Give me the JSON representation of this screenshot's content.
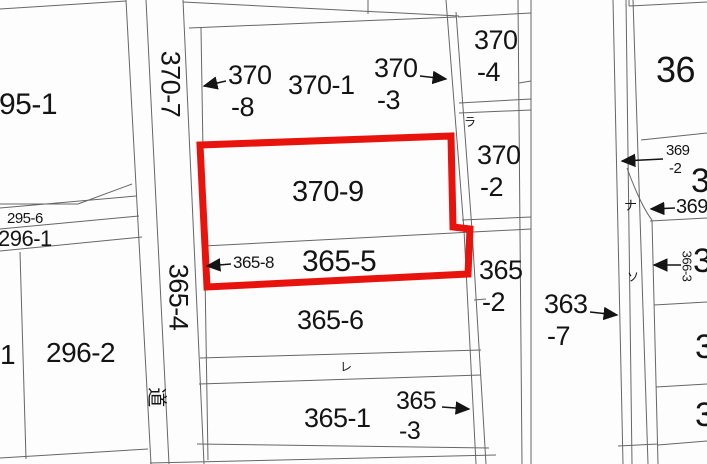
{
  "map": {
    "type": "cadastral-parcel-map",
    "colors": {
      "background": "#fdfdfd",
      "boundary_line": "#666666",
      "label_text": "#141414",
      "highlight_outline": "#e8130d"
    },
    "highlighted_parcels": [
      "370-9",
      "365-5"
    ],
    "labels": {
      "p295_1": {
        "text": "95-1"
      },
      "p370_7": {
        "text": "370-7"
      },
      "p370_8": {
        "line1": "370",
        "line2": "-8",
        "label": "370-8"
      },
      "p370_1": {
        "text": "370-1"
      },
      "p370_3": {
        "line1": "370",
        "line2": "-3",
        "label": "370-3"
      },
      "p370_4": {
        "line1": "370",
        "line2": "-4",
        "label": "370-4"
      },
      "p370_2": {
        "line1": "370",
        "line2": "-2",
        "label": "370-2"
      },
      "p370_9": {
        "text": "370-9"
      },
      "p365_8": {
        "text": "365-8"
      },
      "p365_5": {
        "text": "365-5"
      },
      "p365_4": {
        "text": "365-4"
      },
      "p365_6": {
        "text": "365-6"
      },
      "p365_1": {
        "text": "365-1"
      },
      "p365_3": {
        "line1": "365",
        "line2": "-3",
        "label": "365-3"
      },
      "p365_2": {
        "line1": "365",
        "line2": "-2",
        "label": "365-2"
      },
      "p363_7": {
        "line1": "363",
        "line2": "-7",
        "label": "363-7"
      },
      "p295_6": {
        "text": "295-6"
      },
      "p296_1": {
        "text": "296-1"
      },
      "p296_2": {
        "text": "296-2"
      },
      "p1_edge": {
        "text": "1"
      },
      "p36_edge": {
        "text": "36"
      },
      "p369_2": {
        "line1": "369",
        "line2": "-2",
        "label": "369-2"
      },
      "p3_edge_a": {
        "text": "3"
      },
      "p369_edge": {
        "text": "369"
      },
      "p366_3": {
        "text": "366-3"
      },
      "p3_edge_b": {
        "text": "3"
      },
      "p3_edge_c": {
        "text": "3"
      },
      "p3_edge_d": {
        "text": "3"
      },
      "kana_ra": {
        "text": "ラ"
      },
      "kana_re": {
        "text": "レ"
      },
      "kana_so": {
        "text": "ソ"
      },
      "kana_na": {
        "text": "ナ"
      },
      "kanji_michi": {
        "text": "道"
      }
    }
  }
}
